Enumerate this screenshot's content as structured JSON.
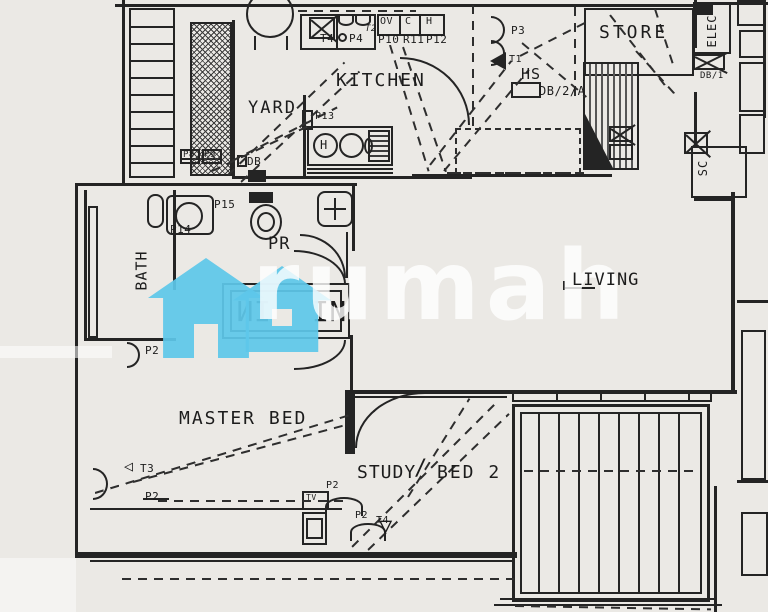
{
  "watermark": {
    "brand": "rumah",
    "house_color": "#5ec7ea"
  },
  "rooms": {
    "kitchen": "KITCHEN",
    "yard": "YARD",
    "bath": "BATH",
    "pr": "PR",
    "living": "LIVING",
    "master_bed": "MASTER BED",
    "study": "STUDY",
    "study_sep": "/",
    "bed2": "BED 2",
    "store": "STORE",
    "elec": "ELEC",
    "sc": "SC"
  },
  "points": {
    "t4": "T4",
    "p4": "P4",
    "ov": "OV",
    "c": "C",
    "h": "H",
    "p10": "P10",
    "r11": "R11",
    "p12": "P12",
    "t2": "T2",
    "p13": "P13",
    "db_yard": "DB",
    "p8": "P8",
    "p9": "P9",
    "p3": "P3",
    "t1": "T1",
    "hs": "HS",
    "db2a": "DB/2/A",
    "db1": "DB/1",
    "p14": "P14",
    "p15": "P15",
    "p2_bath": "P2",
    "t3": "T3",
    "p2_master": "P2",
    "tv": "TV",
    "p2_tv": "P2",
    "p2_study": "P2",
    "t4_study": "T4",
    "sink_h": "H",
    "closet_left": "IN",
    "closet_right": "IN"
  },
  "icons": {
    "tri_left": "◁",
    "tri_down": "▽"
  }
}
